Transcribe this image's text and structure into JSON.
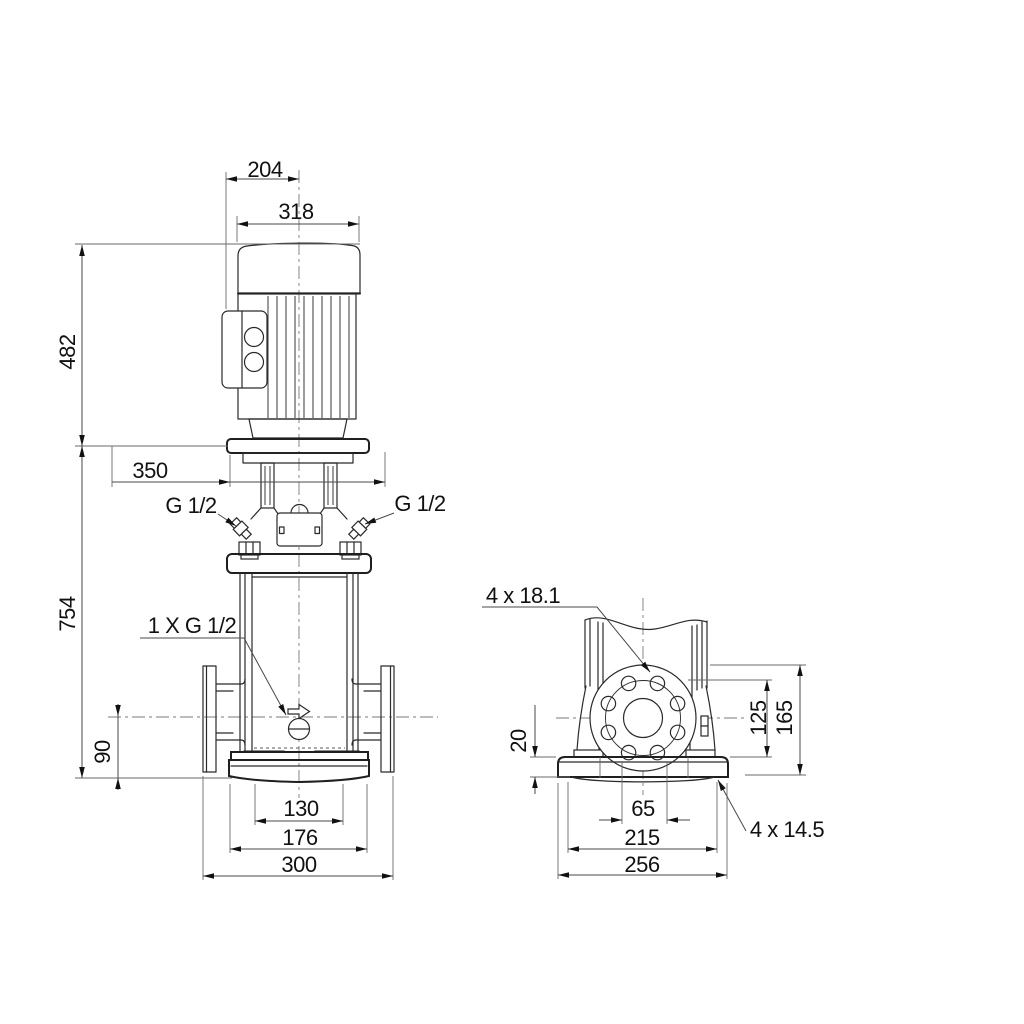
{
  "drawing": {
    "background": "#ffffff",
    "part_line_color": "#2a2a2a",
    "dimension_line_color": "#4a4a4a",
    "text_color": "#111111"
  },
  "front_view": {
    "dims": {
      "d204": "204",
      "d318": "318",
      "d482": "482",
      "d350": "350",
      "d754": "754",
      "d90": "90",
      "d130": "130",
      "d176": "176",
      "d300": "300",
      "g12_left": "G 1/2",
      "g12_right": "G 1/2",
      "drain": "1 X G 1/2"
    }
  },
  "side_view": {
    "dims": {
      "flange_holes": "4 x 18.1",
      "d20": "20",
      "d125": "125",
      "d165": "165",
      "d65": "65",
      "d215": "215",
      "d256": "256",
      "base_holes": "4 x 14.5"
    }
  }
}
